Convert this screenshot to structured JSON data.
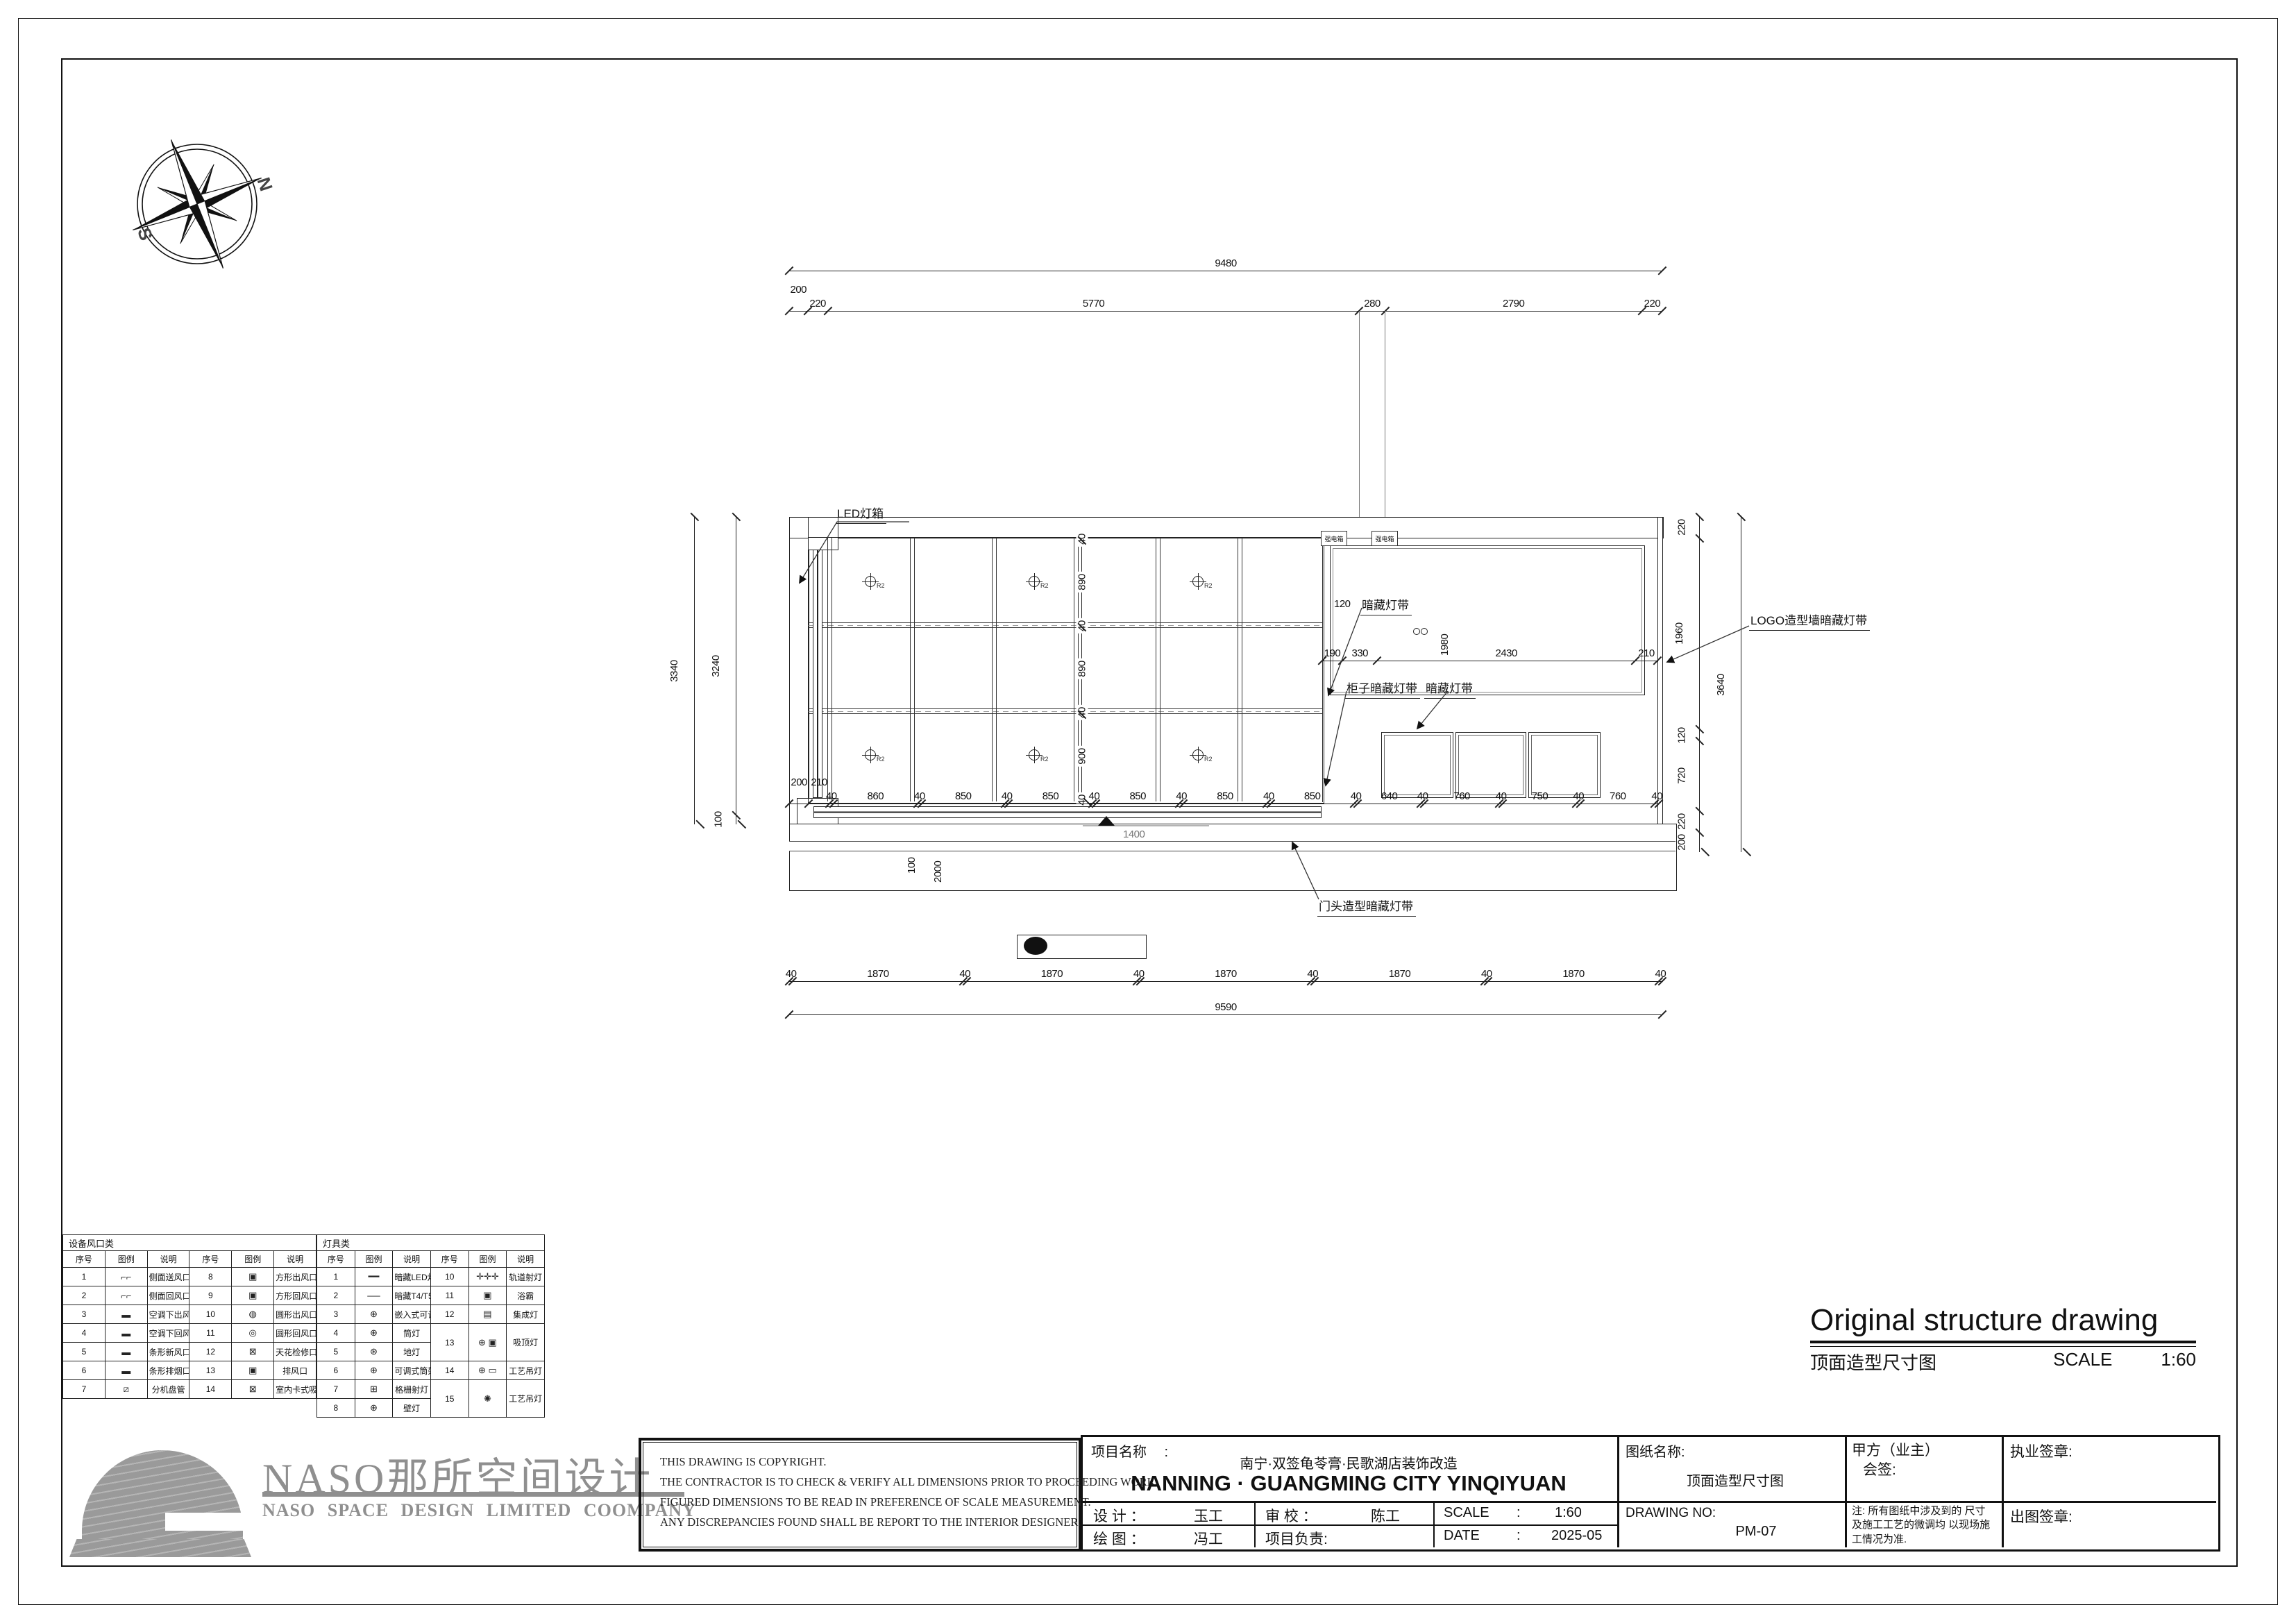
{
  "compass": {
    "north": "N",
    "south": "S"
  },
  "drawing": {
    "labels": {
      "led_box": "LED灯箱",
      "hidden_strip_top": "暗藏灯带",
      "cabinet_strip": "柜子暗藏灯带",
      "hidden_strip_low": "暗藏灯带",
      "logo_wall_strip": "LOGO造型墙暗藏灯带",
      "door_head_strip": "门头造型暗藏灯带",
      "elec_box": "强电箱",
      "marker": "R2"
    },
    "dims": {
      "top_total": [
        "9480"
      ],
      "top_chain": [
        "200",
        "220",
        "5770",
        "280",
        "2790",
        "220"
      ],
      "left_outer": [
        "3340"
      ],
      "left_inner": [
        "3240",
        "100"
      ],
      "right_chain": [
        "220",
        "1960",
        "120",
        "720",
        "220",
        "200"
      ],
      "right_outer": [
        "3640"
      ],
      "right_wall_extra": "200",
      "grid_rows": [
        "40",
        "890",
        "40",
        "890",
        "40",
        "900",
        "40"
      ],
      "col_chain": [
        "200",
        "210",
        "40",
        "860",
        "40",
        "850",
        "40",
        "850",
        "40",
        "850",
        "40",
        "850",
        "40",
        "850",
        "40",
        "640",
        "40",
        "760",
        "40",
        "750",
        "40",
        "760",
        "40"
      ],
      "logo_chain": [
        "190",
        "330",
        "2430",
        "210"
      ],
      "logo_height": "1980",
      "logo_inset": "120",
      "bottom_chain": [
        "40",
        "1870",
        "40",
        "1870",
        "40",
        "1870",
        "40",
        "1870",
        "40",
        "1870",
        "40"
      ],
      "bottom_total": [
        "9590"
      ],
      "door_dim_a": "100",
      "door_dim_b": "2000",
      "door_dim_c": "1400"
    }
  },
  "legend": {
    "vent_table": {
      "title": "设备风口类",
      "headers": [
        "序号",
        "图例",
        "说明",
        "序号",
        "图例",
        "说明"
      ],
      "rows": [
        [
          "1",
          "⌐⌐",
          "侧面送风口",
          "8",
          "▣",
          "方形出风口"
        ],
        [
          "2",
          "⌐⌐",
          "侧面回风口",
          "9",
          "▣",
          "方形回风口"
        ],
        [
          "3",
          "▬",
          "空调下出风口",
          "10",
          "◍",
          "圆形出风口"
        ],
        [
          "4",
          "▬",
          "空调下回风口",
          "11",
          "◎",
          "圆形回风口"
        ],
        [
          "5",
          "▬",
          "条形新风口",
          "12",
          "⊠",
          "天花检修口"
        ],
        [
          "6",
          "▬",
          "条形排烟口",
          "13",
          "▣",
          "排风口"
        ],
        [
          "7",
          "⧄",
          "分机盘管",
          "14",
          "⊠",
          "室内卡式吸顶空调机"
        ]
      ]
    },
    "light_table": {
      "title": "灯具类",
      "headers": [
        "序号",
        "图例",
        "说明",
        "序号",
        "图例",
        "说明"
      ],
      "rows": [
        [
          "1",
          "━━",
          "暗藏LED灯带",
          "10",
          "✛✛✛",
          "轨道射灯"
        ],
        [
          "2",
          "──",
          "暗藏T4/T5日光灯管",
          "11",
          "▣",
          "浴霸"
        ],
        [
          "3",
          "⊕",
          "嵌入式可调节射灯",
          "12",
          "▤",
          "集成灯"
        ],
        [
          "4",
          "⊕",
          "筒灯",
          "13",
          "⊕ ▣",
          "吸顶灯"
        ],
        [
          "5",
          "⊛",
          "地灯",
          null,
          null,
          null
        ],
        [
          "6",
          "⊕",
          "可调式筒架射灯",
          "14",
          "⊕ ▭",
          "工艺吊灯"
        ],
        [
          "7",
          "⊞",
          "格栅射灯",
          "15",
          "✺",
          "工艺吊灯"
        ],
        [
          "8",
          "⊕",
          "壁灯",
          null,
          null,
          null
        ]
      ]
    }
  },
  "title_area": {
    "en_title": "Original structure drawing",
    "cn_title": "顶面造型尺寸图",
    "scale_label": "SCALE",
    "scale_value": "1:60"
  },
  "footer": {
    "brand_cn": "NASO那所空间设计",
    "brand_en": "NASO SPACE DESIGN LIMITED COOMPANY",
    "copyright_lines": [
      "THIS DRAWING IS COPYRIGHT.",
      "THE CONTRACTOR IS TO CHECK & VERIFY ALL DIMENSIONS PRIOR TO PROCEEDING WORK.",
      "FIGURED DIMENSIONS TO BE READ IN PREFERENCE OF SCALE MEASUREMENT.",
      "ANY DISCREPANCIES FOUND SHALL BE REPORT TO THE INTERIOR DESIGNER."
    ],
    "project_label": "项目名称　 :",
    "project_name_cn": "南宁·双签龟苓膏·民歌湖店装饰改造",
    "project_name_en": "NANNING · GUANGMING CITY YINQIYUAN",
    "design_label": "设  计  ：",
    "design_value": "玉工",
    "check_label": "审  校  ：",
    "check_value": "陈工",
    "scale_label": "SCALE",
    "scale_colon": ":",
    "scale_value": "1:60",
    "draw_label": "绘  图  ：",
    "draw_value": "冯工",
    "pm_label": "项目负责:",
    "date_label": "DATE",
    "date_colon": ":",
    "date_value": "2025-05",
    "sheet_name_label": "图纸名称:",
    "sheet_name": "顶面造型尺寸图",
    "drawing_no_label": "DRAWING NO:",
    "drawing_no": "PM-07",
    "owner_label": "甲方（业主）",
    "owner_sub": "会签:",
    "note_text": "注: 所有图纸中涉及到的 尺寸及施工工艺的微调均 以现场施工情况为准.",
    "license_seal": "执业签章:",
    "issue_seal": "出图签章:"
  }
}
